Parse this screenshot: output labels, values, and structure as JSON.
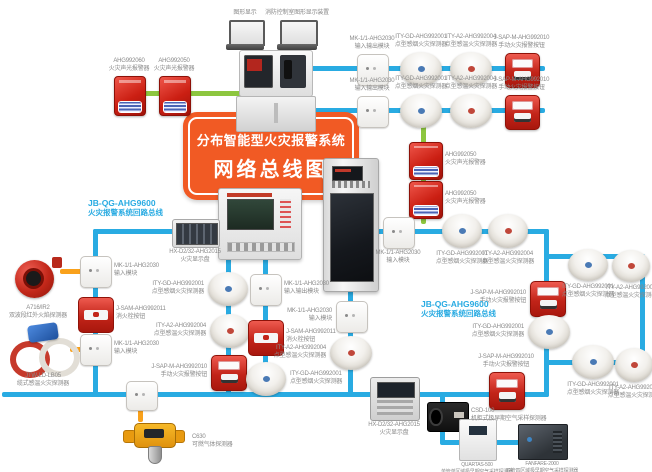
{
  "title": {
    "line1": "分布智能型火灾报警系统",
    "line2": "网络总线图"
  },
  "colors": {
    "bus": "#29abe2",
    "branch": "#8dc63f",
    "wire": "#f9a11b",
    "stand": "#9a9a9a",
    "title_bg": "#f15a24",
    "bus_label": "#29abe2",
    "label_text": "#8a8a8a"
  },
  "bus_labels": [
    {
      "model": "JB-QG-AHG9600",
      "name": "火灾报警系统回路总线",
      "x": 88,
      "y": 198
    },
    {
      "model": "JB-QG-AHG9600",
      "name": "火灾报警系统回路总线",
      "x": 421,
      "y": 299
    }
  ],
  "lines": [
    {
      "x": 243,
      "y": 45,
      "w": 3,
      "h": 9,
      "c": "stand"
    },
    {
      "x": 295,
      "y": 45,
      "w": 3,
      "h": 9,
      "c": "stand"
    },
    {
      "x": 118,
      "y": 91,
      "w": 124,
      "h": 5,
      "c": "branch"
    },
    {
      "x": 421,
      "y": 110,
      "w": 5,
      "h": 114,
      "c": "branch"
    },
    {
      "x": 310,
      "y": 66,
      "w": 235,
      "h": 5,
      "c": "bus"
    },
    {
      "x": 310,
      "y": 108,
      "w": 235,
      "h": 5,
      "c": "bus"
    },
    {
      "x": 93,
      "y": 229,
      "w": 128,
      "h": 5,
      "c": "bus"
    },
    {
      "x": 93,
      "y": 229,
      "w": 5,
      "h": 168,
      "c": "bus"
    },
    {
      "x": 2,
      "y": 392,
      "w": 547,
      "h": 5,
      "c": "bus"
    },
    {
      "x": 226,
      "y": 257,
      "w": 5,
      "h": 137,
      "c": "bus"
    },
    {
      "x": 263,
      "y": 257,
      "w": 5,
      "h": 137,
      "c": "bus"
    },
    {
      "x": 348,
      "y": 289,
      "w": 5,
      "h": 105,
      "c": "bus"
    },
    {
      "x": 377,
      "y": 229,
      "w": 172,
      "h": 5,
      "c": "bus"
    },
    {
      "x": 544,
      "y": 229,
      "w": 5,
      "h": 168,
      "c": "bus"
    },
    {
      "x": 544,
      "y": 254,
      "w": 101,
      "h": 5,
      "c": "bus"
    },
    {
      "x": 640,
      "y": 254,
      "w": 5,
      "h": 111,
      "c": "bus"
    },
    {
      "x": 544,
      "y": 360,
      "w": 101,
      "h": 5,
      "c": "bus"
    },
    {
      "x": 440,
      "y": 394,
      "w": 5,
      "h": 50,
      "c": "bus"
    },
    {
      "x": 440,
      "y": 440,
      "w": 104,
      "h": 5,
      "c": "bus"
    },
    {
      "x": 60,
      "y": 269,
      "w": 22,
      "h": 5,
      "c": "wire"
    },
    {
      "x": 70,
      "y": 347,
      "w": 14,
      "h": 5,
      "c": "wire"
    },
    {
      "x": 138,
      "y": 406,
      "w": 5,
      "h": 16,
      "c": "wire"
    }
  ],
  "devices": [
    {
      "id": "laptop-left",
      "type": "laptop",
      "x": 226,
      "y": 20,
      "w": 38,
      "h": 30,
      "lp": "above",
      "label": {
        "model": "",
        "name": "图形显示"
      }
    },
    {
      "id": "laptop-right",
      "type": "laptop",
      "x": 277,
      "y": 20,
      "w": 40,
      "h": 30,
      "lp": "above",
      "label": {
        "model": "",
        "name": "消防控制室图形显示装置"
      }
    },
    {
      "id": "control-console",
      "type": "console",
      "x": 236,
      "y": 50,
      "w": 78,
      "h": 82,
      "lp": "none",
      "label": null
    },
    {
      "id": "sound-light-alarm-top-1",
      "type": "alarm",
      "x": 114,
      "y": 76,
      "w": 30,
      "h": 38,
      "lp": "above",
      "label": {
        "model": "AHG992060",
        "name": "火灾声光报警器"
      }
    },
    {
      "id": "sound-light-alarm-top-2",
      "type": "alarm",
      "x": 159,
      "y": 76,
      "w": 30,
      "h": 38,
      "lp": "above",
      "label": {
        "model": "AHG992050",
        "name": "火灾声光报警器"
      }
    },
    {
      "id": "io-module-top-1",
      "type": "module",
      "x": 357,
      "y": 54,
      "w": 30,
      "h": 30,
      "lp": "above",
      "label": {
        "model": "MK-1/1-AHG2030",
        "name": "输入输出模块"
      }
    },
    {
      "id": "smoke-detector-top-1",
      "type": "smoke",
      "x": 400,
      "y": 52,
      "w": 42,
      "h": 34,
      "lp": "above",
      "label": {
        "model": "ITY-GD-AHG992001",
        "name": "点型感烟火灾探测器"
      }
    },
    {
      "id": "heat-detector-top-1",
      "type": "heat",
      "x": 450,
      "y": 52,
      "w": 42,
      "h": 34,
      "lp": "above",
      "label": {
        "model": "ITY-A2-AHG992004",
        "name": "点型感温火灾探测器"
      }
    },
    {
      "id": "manual-call-point-top-1",
      "type": "mcp",
      "x": 505,
      "y": 53,
      "w": 33,
      "h": 33,
      "lp": "above",
      "label": {
        "model": "J-SAP-M-AHG992010",
        "name": "手动火灾报警按钮"
      }
    },
    {
      "id": "io-module-top-2",
      "type": "module",
      "x": 357,
      "y": 96,
      "w": 30,
      "h": 30,
      "lp": "above",
      "label": {
        "model": "MK-1/1-AHG2030",
        "name": "输入输出模块"
      }
    },
    {
      "id": "smoke-detector-top-2",
      "type": "smoke",
      "x": 400,
      "y": 94,
      "w": 42,
      "h": 34,
      "lp": "above",
      "label": {
        "model": "ITY-GD-AHG992001",
        "name": "点型感烟火灾探测器"
      }
    },
    {
      "id": "heat-detector-top-2",
      "type": "heat",
      "x": 450,
      "y": 94,
      "w": 42,
      "h": 34,
      "lp": "above",
      "label": {
        "model": "ITY-A2-AHG992004",
        "name": "点型感温火灾探测器"
      }
    },
    {
      "id": "manual-call-point-top-2",
      "type": "mcp",
      "x": 505,
      "y": 95,
      "w": 33,
      "h": 33,
      "lp": "above",
      "label": {
        "model": "J-SAP-M-AHG992010",
        "name": "手动火灾报警按钮"
      }
    },
    {
      "id": "sound-light-alarm-right-1",
      "type": "alarm",
      "x": 409,
      "y": 142,
      "w": 32,
      "h": 36,
      "lp": "right",
      "label": {
        "model": "AHG992050",
        "name": "火灾声光报警器"
      }
    },
    {
      "id": "sound-light-alarm-right-2",
      "type": "alarm",
      "x": 409,
      "y": 181,
      "w": 32,
      "h": 36,
      "lp": "right",
      "label": {
        "model": "AHG992050",
        "name": "火灾声光报警器"
      }
    },
    {
      "id": "loop-control-panel",
      "type": "wallpanel",
      "x": 218,
      "y": 188,
      "w": 82,
      "h": 70,
      "lp": "none",
      "label": null
    },
    {
      "id": "loop-control-cabinet",
      "type": "cabinet",
      "x": 323,
      "y": 158,
      "w": 54,
      "h": 132,
      "lp": "none",
      "label": null
    },
    {
      "id": "fire-display-panel-1",
      "type": "display",
      "x": 172,
      "y": 219,
      "w": 46,
      "h": 27,
      "lp": "below",
      "label": {
        "model": "HX-D2/32-AHG2015",
        "name": "火灾显示盘"
      }
    },
    {
      "id": "input-module-left-1",
      "type": "module",
      "x": 80,
      "y": 256,
      "w": 30,
      "h": 30,
      "lp": "right",
      "label": {
        "model": "MK-1/1-AHG2030",
        "name": "输入模块"
      }
    },
    {
      "id": "hydrant-button-left",
      "type": "hydrant",
      "x": 78,
      "y": 297,
      "w": 34,
      "h": 34,
      "lp": "right",
      "label": {
        "model": "J-SAM-AHG992011",
        "name": "消火栓按钮"
      }
    },
    {
      "id": "input-module-left-2",
      "type": "module",
      "x": 80,
      "y": 334,
      "w": 30,
      "h": 30,
      "lp": "right",
      "label": {
        "model": "MK-1/1-AHG2030",
        "name": "输入模块"
      }
    },
    {
      "id": "flame-detector",
      "type": "flame",
      "x": 14,
      "y": 256,
      "w": 48,
      "h": 46,
      "lp": "below",
      "label": {
        "model": "A716/IR2",
        "name": "双波段红外火焰探测器"
      }
    },
    {
      "id": "cable-heat-detector",
      "type": "cable",
      "x": 10,
      "y": 324,
      "w": 66,
      "h": 46,
      "lp": "below",
      "label": {
        "model": "JTW-LD-LB05",
        "name": "缆式感温火灾探测器"
      }
    },
    {
      "id": "input-module-gas",
      "type": "module",
      "x": 126,
      "y": 381,
      "w": 30,
      "h": 28,
      "lp": "none",
      "label": null
    },
    {
      "id": "gas-detector",
      "type": "gas",
      "x": 120,
      "y": 420,
      "w": 68,
      "h": 44,
      "lp": "right",
      "label": {
        "model": "C630",
        "name": "可燃气体探测器"
      }
    },
    {
      "id": "smoke-detector-mid-1",
      "type": "smoke",
      "x": 208,
      "y": 272,
      "w": 40,
      "h": 34,
      "lp": "left",
      "label": {
        "model": "ITY-GD-AHG992001",
        "name": "点型感烟火灾探测器"
      }
    },
    {
      "id": "heat-detector-mid-1",
      "type": "heat",
      "x": 210,
      "y": 314,
      "w": 40,
      "h": 34,
      "lp": "left",
      "label": {
        "model": "ITY-A2-AHG992004",
        "name": "点型感温火灾探测器"
      }
    },
    {
      "id": "manual-call-point-mid-1",
      "type": "mcp",
      "x": 211,
      "y": 355,
      "w": 34,
      "h": 34,
      "lp": "left",
      "label": {
        "model": "J-SAP-M-AHG992010",
        "name": "手动火灾报警按钮"
      }
    },
    {
      "id": "io-module-mid-1",
      "type": "module",
      "x": 250,
      "y": 274,
      "w": 30,
      "h": 30,
      "lp": "right",
      "label": {
        "model": "MK-1/1-AHG2030",
        "name": "输入输出模块"
      }
    },
    {
      "id": "hydrant-button-mid",
      "type": "hydrant",
      "x": 248,
      "y": 320,
      "w": 34,
      "h": 34,
      "lp": "right",
      "label": {
        "model": "J-SAM-AHG992011",
        "name": "消火栓按钮"
      }
    },
    {
      "id": "smoke-detector-mid-2",
      "type": "smoke",
      "x": 246,
      "y": 362,
      "w": 40,
      "h": 34,
      "lp": "right",
      "label": {
        "model": "ITY-GD-AHG992001",
        "name": "点型感烟火灾探测器"
      }
    },
    {
      "id": "input-module-cab",
      "type": "module",
      "x": 336,
      "y": 301,
      "w": 30,
      "h": 30,
      "lp": "left",
      "label": {
        "model": "MK-1/1-AHG2030",
        "name": "输入模块"
      }
    },
    {
      "id": "heat-detector-cab",
      "type": "heat",
      "x": 330,
      "y": 336,
      "w": 42,
      "h": 34,
      "lp": "left",
      "label": {
        "model": "ITY-A2-AHG992004",
        "name": "点型感温火灾探测器"
      }
    },
    {
      "id": "fire-display-panel-2",
      "type": "display2",
      "x": 370,
      "y": 377,
      "w": 48,
      "h": 42,
      "lp": "below",
      "label": {
        "model": "HX-D2/32-AHG2015",
        "name": "火灾显示盘"
      }
    },
    {
      "id": "input-module-right",
      "type": "module",
      "x": 383,
      "y": 217,
      "w": 30,
      "h": 30,
      "lp": "below",
      "label": {
        "model": "MK-1/1-AHG2030",
        "name": "输入模块"
      }
    },
    {
      "id": "smoke-detector-right-1",
      "type": "smoke",
      "x": 442,
      "y": 214,
      "w": 40,
      "h": 34,
      "lp": "below",
      "label": {
        "model": "ITY-GD-AHG992001",
        "name": "点型感烟火灾探测器"
      }
    },
    {
      "id": "heat-detector-right-1",
      "type": "heat",
      "x": 488,
      "y": 214,
      "w": 40,
      "h": 34,
      "lp": "below",
      "label": {
        "model": "ITY-A2-AHG992004",
        "name": "点型感温火灾探测器"
      }
    },
    {
      "id": "manual-call-point-right",
      "type": "mcp",
      "x": 530,
      "y": 281,
      "w": 34,
      "h": 34,
      "lp": "left",
      "label": {
        "model": "J-SAP-M-AHG992010",
        "name": "手动火灾报警按钮"
      }
    },
    {
      "id": "smoke-detector-right-2",
      "type": "smoke",
      "x": 528,
      "y": 315,
      "w": 42,
      "h": 34,
      "lp": "left",
      "label": {
        "model": "ITY-GD-AHG992001",
        "name": "点型感烟火灾探测器"
      }
    },
    {
      "id": "smoke-detector-right-3",
      "type": "smoke",
      "x": 568,
      "y": 249,
      "w": 40,
      "h": 32,
      "lp": "below",
      "label": {
        "model": "ITY-GD-AHG992001",
        "name": "点型感烟火灾探测器"
      }
    },
    {
      "id": "heat-detector-right-2",
      "type": "heat",
      "x": 612,
      "y": 250,
      "w": 38,
      "h": 32,
      "lp": "below",
      "label": {
        "model": "ITY-A2-AHG992004",
        "name": "点型感温火灾探测器"
      }
    },
    {
      "id": "smoke-detector-right-4",
      "type": "smoke",
      "x": 572,
      "y": 345,
      "w": 42,
      "h": 34,
      "lp": "below",
      "label": {
        "model": "ITY-GD-AHG992001",
        "name": "点型感烟火灾探测器"
      }
    },
    {
      "id": "heat-detector-right-3",
      "type": "heat",
      "x": 615,
      "y": 348,
      "w": 38,
      "h": 34,
      "lp": "below",
      "label": {
        "model": "ITY-A2-AHG992004",
        "name": "点型感温火灾探测器"
      }
    },
    {
      "id": "manual-call-point-bottom",
      "type": "mcp",
      "x": 489,
      "y": 372,
      "w": 34,
      "h": 36,
      "lp": "above",
      "label": {
        "model": "J-SAP-M-AHG992010",
        "name": "手动火灾报警按钮"
      }
    },
    {
      "id": "air-sampling-csd",
      "type": "csd",
      "x": 427,
      "y": 402,
      "w": 40,
      "h": 28,
      "lp": "right",
      "label": {
        "model": "CSD-100",
        "name": "机柜式极早期空气采样探测器"
      }
    },
    {
      "id": "air-sampling-quartas",
      "type": "whitebox",
      "x": 459,
      "y": 419,
      "w": 36,
      "h": 40,
      "lp": "below-sm",
      "label": {
        "model": "QUARTAS-500",
        "name": "单管单区域极早期空气采样探测器"
      }
    },
    {
      "id": "air-sampling-fanfare",
      "type": "darkbox",
      "x": 518,
      "y": 424,
      "w": 48,
      "h": 34,
      "lp": "below-sm",
      "label": {
        "model": "FANFARE-2000",
        "name": "四管四区域极早期空气采样探测器"
      }
    }
  ]
}
